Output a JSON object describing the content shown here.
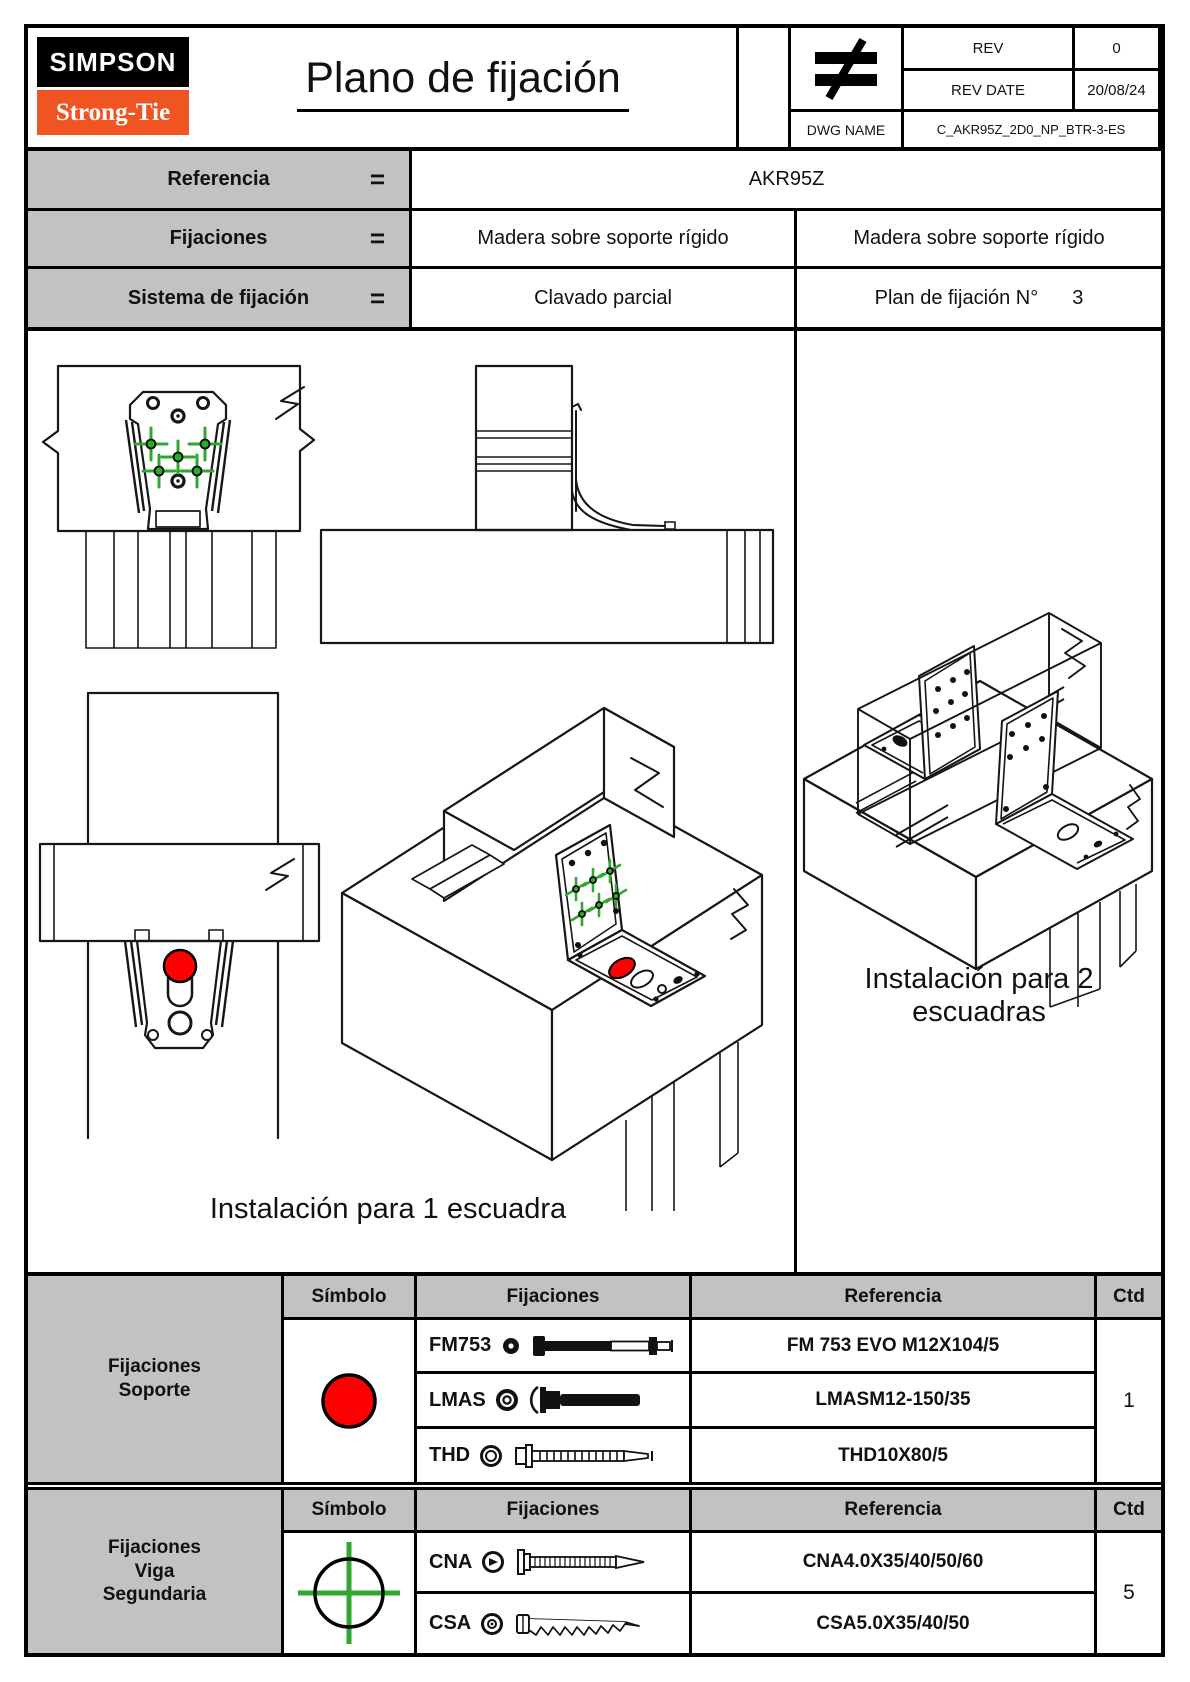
{
  "logo": {
    "top": "SIMPSON",
    "bottom": "Strong-Tie"
  },
  "title": "Plano de fijación",
  "rev_block": {
    "not_equal_icon": "not-equal-icon",
    "rev_label": "REV",
    "rev_value": "0",
    "rev_date_label": "REV DATE",
    "rev_date_value": "20/08/24",
    "dwg_label": "DWG NAME",
    "dwg_value": "C_AKR95Z_2D0_NP_BTR-3-ES"
  },
  "info_table": {
    "row1": {
      "label": "Referencia",
      "eq": "=",
      "value": "AKR95Z"
    },
    "row2": {
      "label": "Fijaciones",
      "eq": "=",
      "left": "Madera sobre soporte rígido",
      "right": "Madera sobre soporte rígido"
    },
    "row3": {
      "label": "Sistema de fijación",
      "eq": "=",
      "left": "Clavado parcial",
      "right_label": "Plan de fijación N°",
      "right_value": "3"
    }
  },
  "drawing_area": {
    "caption_one": "Instalación para 1 escuadra",
    "caption_two_line1": "Instalación para 2",
    "caption_two_line2": "escuadras"
  },
  "tables": [
    {
      "group": [
        "Fijaciones",
        "Soporte"
      ],
      "headers": {
        "symbol": "Símbolo",
        "fixings": "Fijaciones",
        "reference": "Referencia",
        "qty": "Ctd"
      },
      "symbol_icon": "red-circle-icon",
      "rows": [
        {
          "code": "FM753",
          "icon": "fm753-bolt-icon",
          "reference": "FM 753 EVO M12X104/5"
        },
        {
          "code": "LMAS",
          "icon": "lmas-anchor-icon",
          "reference": "LMASM12-150/35"
        },
        {
          "code": "THD",
          "icon": "thd-screw-icon",
          "reference": "THD10X80/5"
        }
      ],
      "qty": "1"
    },
    {
      "group": [
        "Fijaciones",
        "Viga",
        "Segundaria"
      ],
      "headers": {
        "symbol": "Símbolo",
        "fixings": "Fijaciones",
        "reference": "Referencia",
        "qty": "Ctd"
      },
      "symbol_icon": "green-crosshair-icon",
      "rows": [
        {
          "code": "CNA",
          "icon": "cna-nail-icon",
          "reference": "CNA4.0X35/40/50/60"
        },
        {
          "code": "CSA",
          "icon": "csa-screw-icon",
          "reference": "CSA5.0X35/40/50"
        }
      ],
      "qty": "5"
    }
  ],
  "colors": {
    "accent_red": "#ff0000",
    "accent_green": "#2ea82e",
    "logo_orange": "#f05423",
    "header_gray": "#c2c2c2"
  }
}
